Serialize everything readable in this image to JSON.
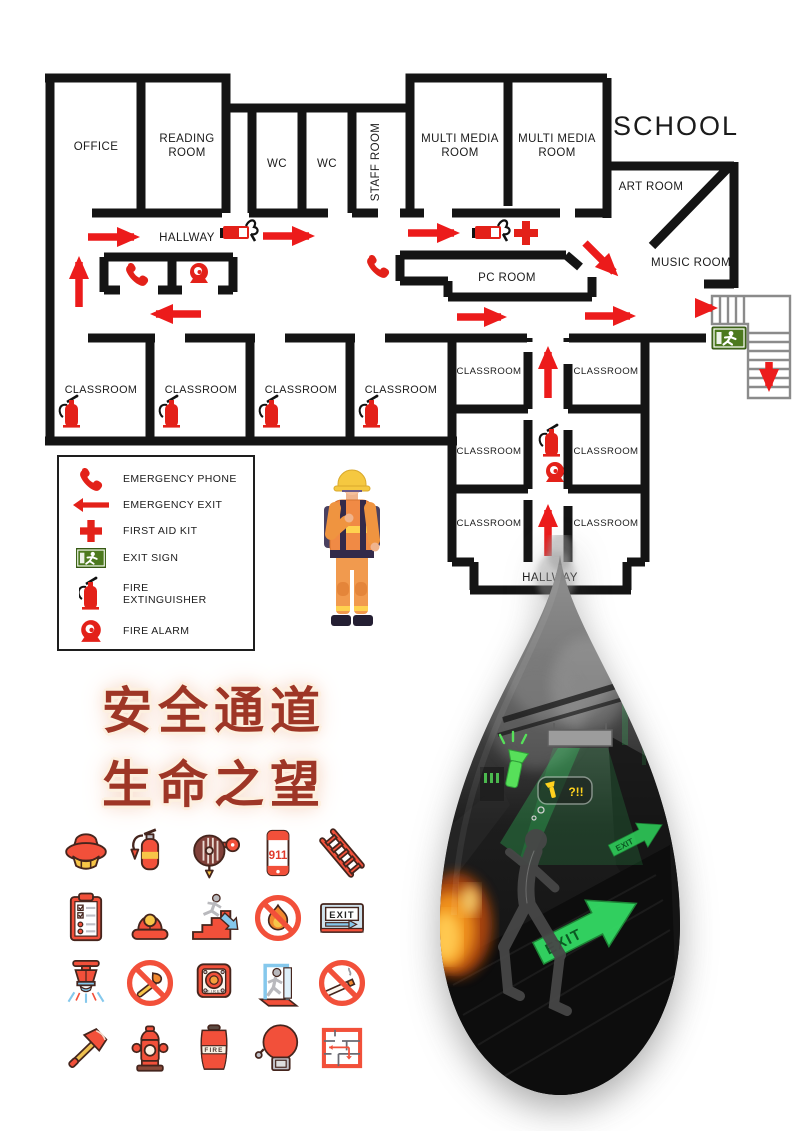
{
  "school_label": "SCHOOL",
  "floor_plan": {
    "rooms": {
      "office": "OFFICE",
      "reading_room": {
        "line1": "READING",
        "line2": "ROOM"
      },
      "wc_left": "WC",
      "wc_right": "WC",
      "staff_room": "STAFF ROOM",
      "multi_media_room": {
        "line1": "MULTI MEDIA",
        "line2": "ROOM"
      },
      "art_room": "ART ROOM",
      "music_room": "MUSIC ROOM",
      "pc_room": "PC ROOM",
      "classroom": "CLASSROOM",
      "hallway_top": "HALLWAY",
      "hallway_bottom": "HALLWAY"
    }
  },
  "legend": {
    "items": [
      {
        "icon": "emergency-phone-icon",
        "label": "EMERGENCY PHONE"
      },
      {
        "icon": "emergency-exit-icon",
        "label": "EMERGENCY EXIT"
      },
      {
        "icon": "first-aid-kit-icon",
        "label": "FIRST AID KIT"
      },
      {
        "icon": "exit-sign-icon",
        "label": "EXIT SIGN"
      },
      {
        "icon": "fire-extinguisher-icon",
        "label": "FIRE EXTINGUISHER",
        "label_line1": "FIRE",
        "label_line2": "EXTINGUISHER"
      },
      {
        "icon": "fire-alarm-icon",
        "label": "FIRE ALARM"
      }
    ]
  },
  "slogan": {
    "line1": "安全通道",
    "line2": "生命之望"
  },
  "icon_grid": {
    "call_number": "911",
    "exit_label": "EXIT",
    "fire_button_label": "FIRE",
    "fire_bucket_label": "FIRE",
    "icons": [
      "smoke-detector-icon",
      "fire-extinguisher-icon",
      "fire-hose-reel-icon",
      "emergency-call-911-icon",
      "fire-ladder-icon",
      "inspection-checklist-icon",
      "emergency-siren-icon",
      "evacuation-stairs-icon",
      "no-open-flame-icon",
      "exit-sign-board-icon",
      "fire-sprinkler-icon",
      "no-matches-icon",
      "fire-alarm-button-icon",
      "emergency-exit-door-icon",
      "no-smoking-icon",
      "fire-axe-icon",
      "fire-hydrant-icon",
      "fire-bucket-icon",
      "fire-bell-icon",
      "evacuation-plan-icon"
    ]
  },
  "drop_scene": {
    "exit_arrow_label": "EXIT",
    "exit_arrow_label_small": "EXIT",
    "bubble_text": "?!!"
  },
  "colors": {
    "wall": "#141414",
    "route_red": "#ec1b1b",
    "exit_green": "#4c791e",
    "slogan_red": "#9e3626",
    "icon_red": "#f2503a",
    "arrow_green": "#35e067"
  }
}
